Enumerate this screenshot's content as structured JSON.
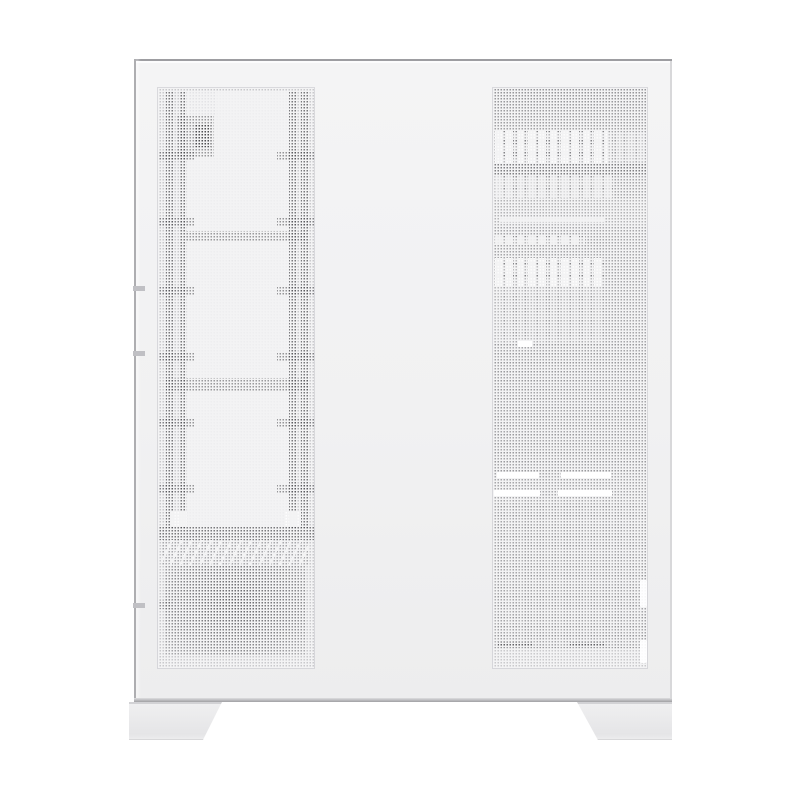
{
  "product": {
    "view_label": "white mesh PC case, product side view on white background",
    "parts": {
      "case_body": "PC case body",
      "left_mesh_panel": "narrow perforated mesh strip with internal frame, rails and PSU shadows",
      "right_mesh_panel": "large perforated mesh side panel with internal component shadows",
      "left_foot": "front trapezoid case foot",
      "right_foot": "rear trapezoid case foot"
    }
  },
  "palette": {
    "page_bg": "#ffffff",
    "case_fill_top": "#f4f4f5",
    "case_fill": "#f1f1f2",
    "case_fill_bot": "#ededee",
    "case_edge": "#9d9da1",
    "case_edge_soft": "#aeaeb1",
    "case_edge_faint": "#d8d8da",
    "case_bottom_edge": "#a0a0a3",
    "seam_tick": "#c0c0c4",
    "mesh_metal": "#f3f3f4",
    "mesh_hole_light": "#c9c9cc",
    "mesh_hole_dark": "#a7a7aa",
    "highlight": "#ffffff",
    "foot_fill": "#f0f0f1",
    "foot_edge": "#d2d2d5"
  }
}
